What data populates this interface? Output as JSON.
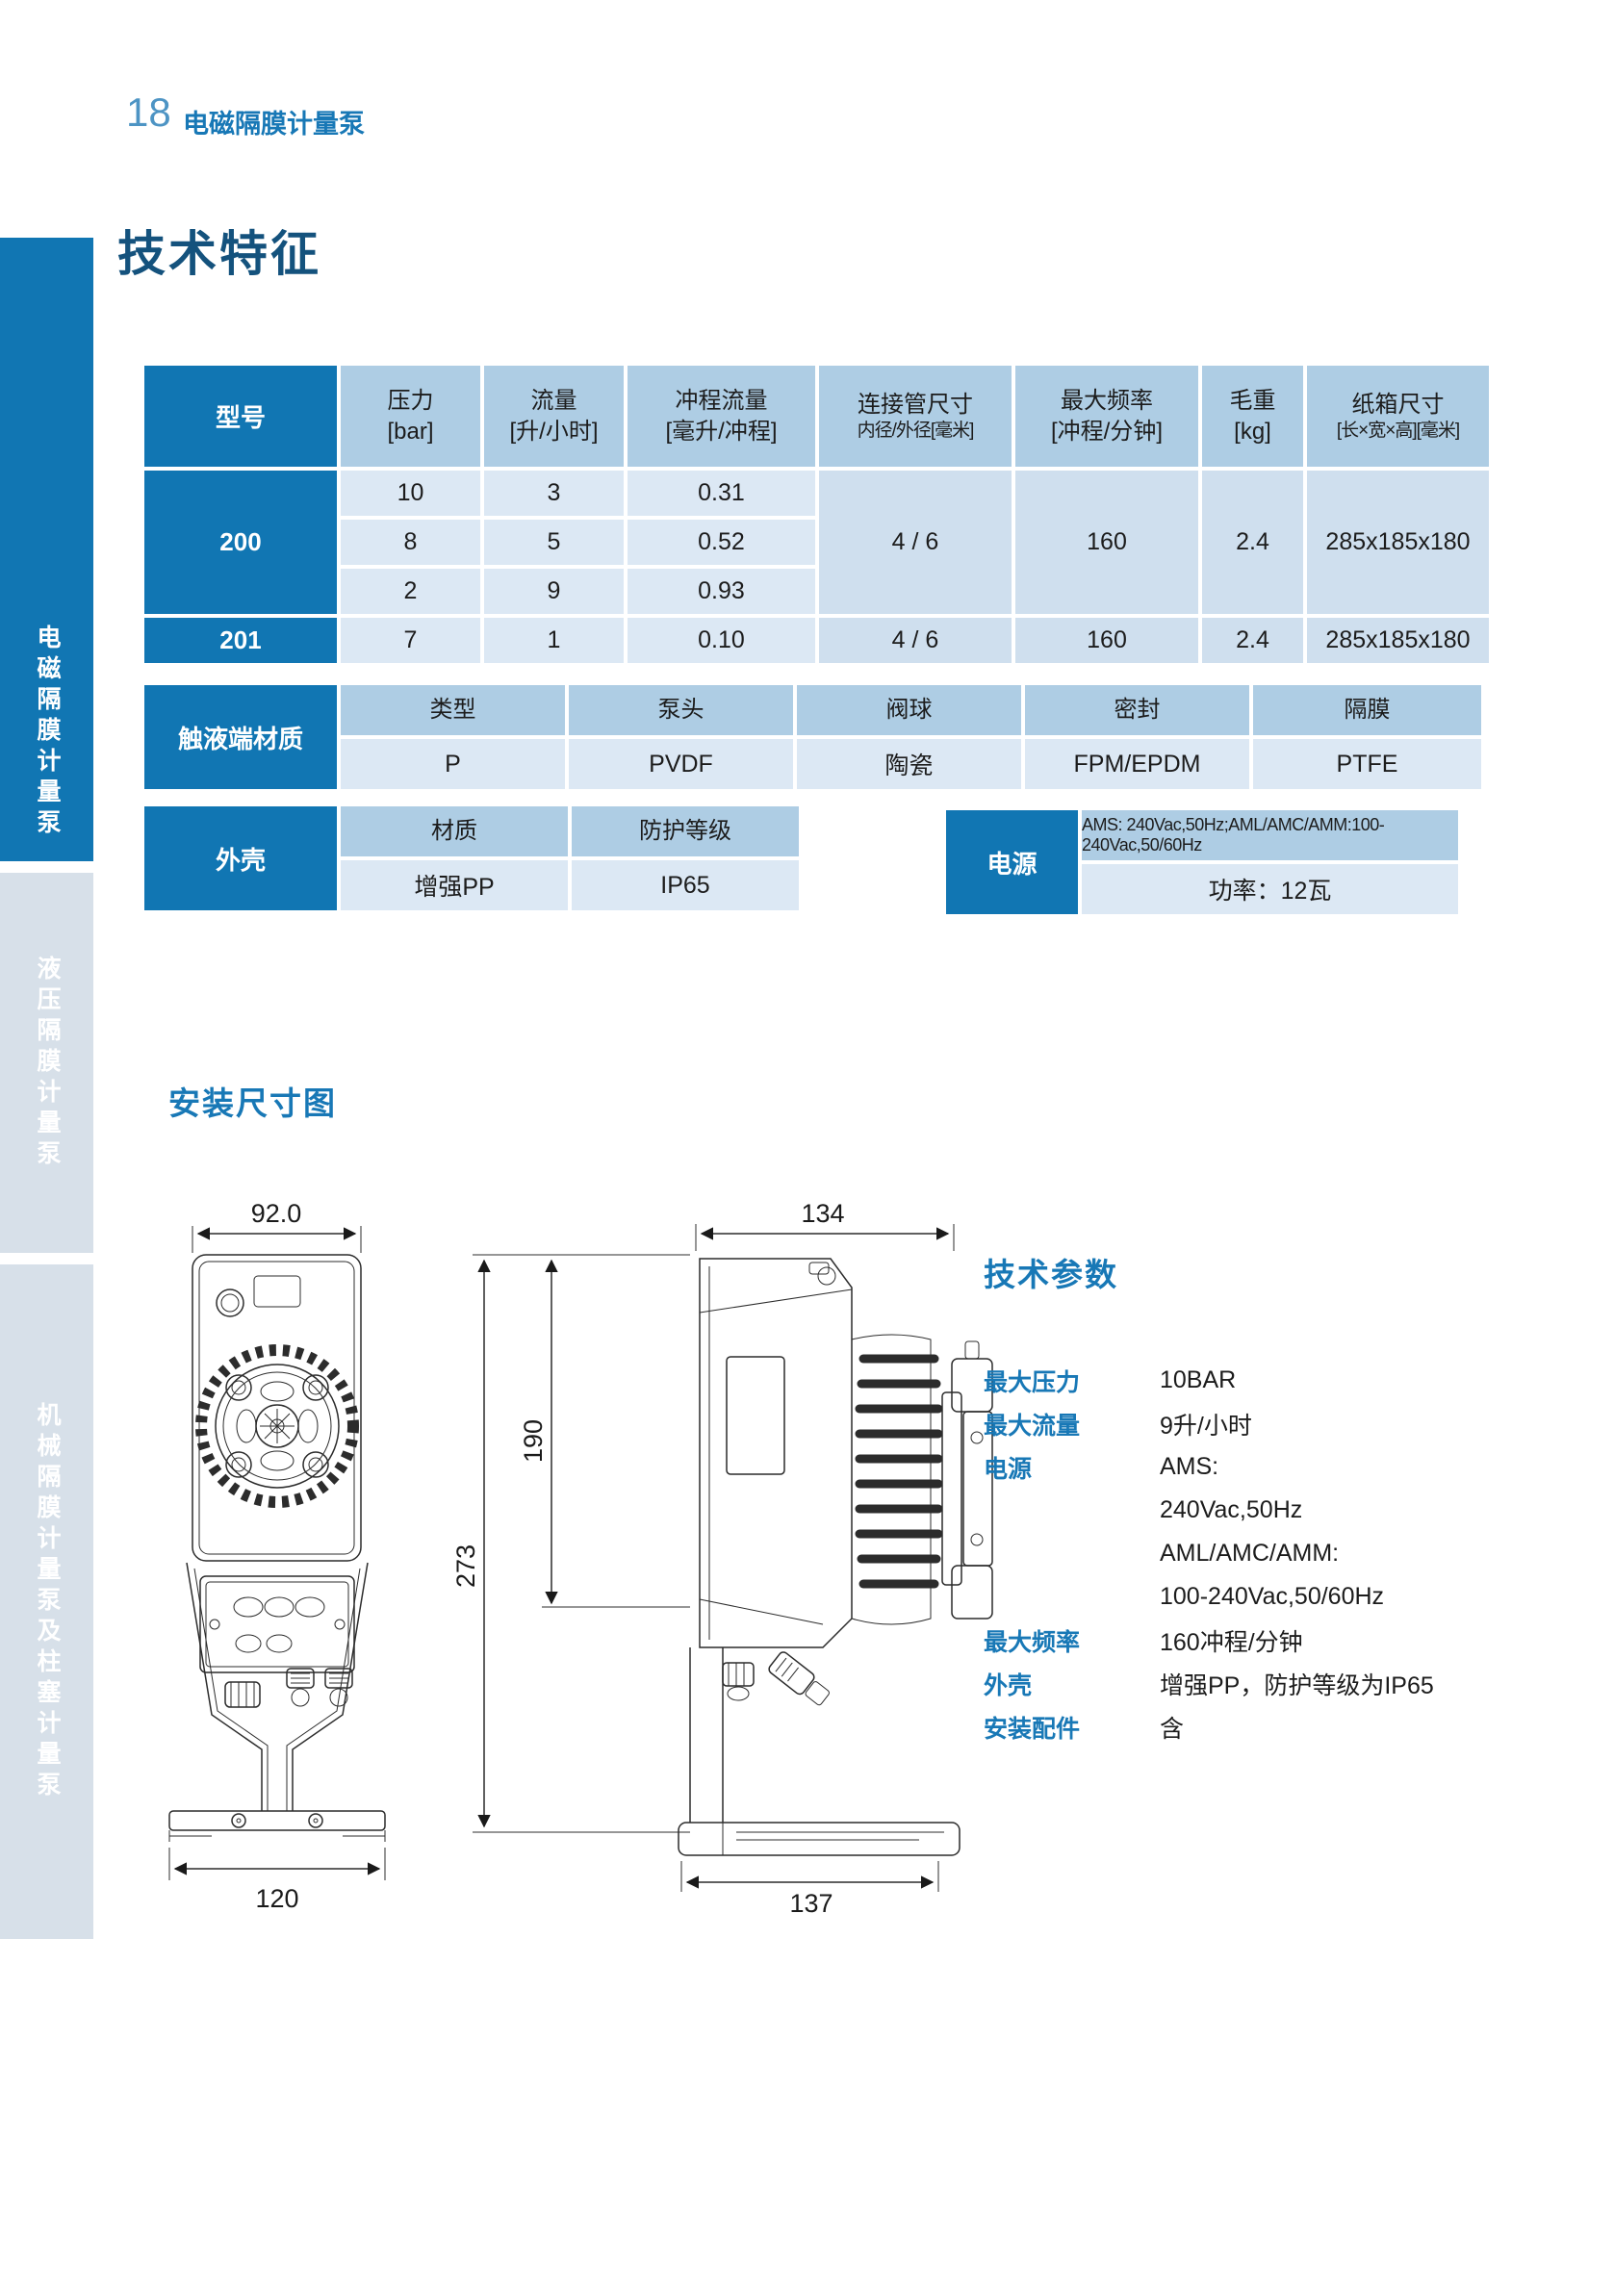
{
  "page": {
    "number": "18",
    "category": "电磁隔膜计量泵",
    "title": "技术特征"
  },
  "sidebar": {
    "tabs": [
      {
        "label": "电磁隔膜计量泵",
        "active": true
      },
      {
        "label": "液压隔膜计量泵",
        "active": false
      },
      {
        "label": "机械隔膜计量泵及柱塞计量泵",
        "active": false
      }
    ]
  },
  "model_table": {
    "headers": [
      {
        "l1": "型号",
        "l2": ""
      },
      {
        "l1": "压力",
        "l2": "[bar]"
      },
      {
        "l1": "流量",
        "l2": "[升/小时]"
      },
      {
        "l1": "冲程流量",
        "l2": "[毫升/冲程]"
      },
      {
        "l1": "连接管尺寸",
        "l2": "内径/外径[毫米]"
      },
      {
        "l1": "最大频率",
        "l2": "[冲程/分钟]"
      },
      {
        "l1": "毛重",
        "l2": "[kg]"
      },
      {
        "l1": "纸箱尺寸",
        "l2": "[长×宽×高][毫米]"
      }
    ],
    "groups": [
      {
        "model": "200",
        "rows": [
          {
            "pressure": "10",
            "flow": "3",
            "stroke": "0.31"
          },
          {
            "pressure": "8",
            "flow": "5",
            "stroke": "0.52"
          },
          {
            "pressure": "2",
            "flow": "9",
            "stroke": "0.93"
          }
        ],
        "pipe": "4 / 6",
        "freq": "160",
        "weight": "2.4",
        "carton": "285x185x180"
      },
      {
        "model": "201",
        "rows": [
          {
            "pressure": "7",
            "flow": "1",
            "stroke": "0.10"
          }
        ],
        "pipe": "4 / 6",
        "freq": "160",
        "weight": "2.4",
        "carton": "285x185x180"
      }
    ]
  },
  "material_table": {
    "label": "触液端材质",
    "cols": [
      {
        "h": "类型",
        "v": "P"
      },
      {
        "h": "泵头",
        "v": "PVDF"
      },
      {
        "h": "阀球",
        "v": "陶瓷"
      },
      {
        "h": "密封",
        "v": "FPM/EPDM"
      },
      {
        "h": "隔膜",
        "v": "PTFE"
      }
    ]
  },
  "housing_table": {
    "label": "外壳",
    "material_header": "材质",
    "protection_header": "防护等级",
    "material_value": "增强PP",
    "protection_value": "IP65"
  },
  "power_table": {
    "label": "电源",
    "supply": "AMS: 240Vac,50Hz;AML/AMC/AMM:100-240Vac,50/60Hz",
    "power": "功率：12瓦"
  },
  "installation": {
    "heading": "安装尺寸图",
    "front_view": {
      "width_dim": "92.0",
      "base_dim": "120"
    },
    "side_view": {
      "width_dim": "134",
      "base_dim": "137",
      "height_dim": "273",
      "height_dim2": "190"
    }
  },
  "tech_params": {
    "heading": "技术参数",
    "items": [
      {
        "label": "最大压力",
        "value": "10BAR"
      },
      {
        "label": "最大流量",
        "value": "9升/小时"
      },
      {
        "label": "电源",
        "value": "AMS:"
      },
      {
        "label": "",
        "value": "240Vac,50Hz"
      },
      {
        "label": "",
        "value": "AML/AMC/AMM:"
      },
      {
        "label": "",
        "value": "100-240Vac,50/60Hz"
      },
      {
        "label": "最大频率",
        "value": "160冲程/分钟"
      },
      {
        "label": "外壳",
        "value": "增强PP，防护等级为IP65"
      },
      {
        "label": "安装配件",
        "value": "含"
      }
    ]
  },
  "colors": {
    "accent_blue": "#1176b3",
    "heading_blue": "#1878b6",
    "title_navy": "#14527d",
    "header_cell_blue": "#aecde4",
    "cell_light_blue": "#dce8f4",
    "cell_mid_blue": "#cfdfee",
    "sidebar_inactive": "#d7e0e9"
  }
}
